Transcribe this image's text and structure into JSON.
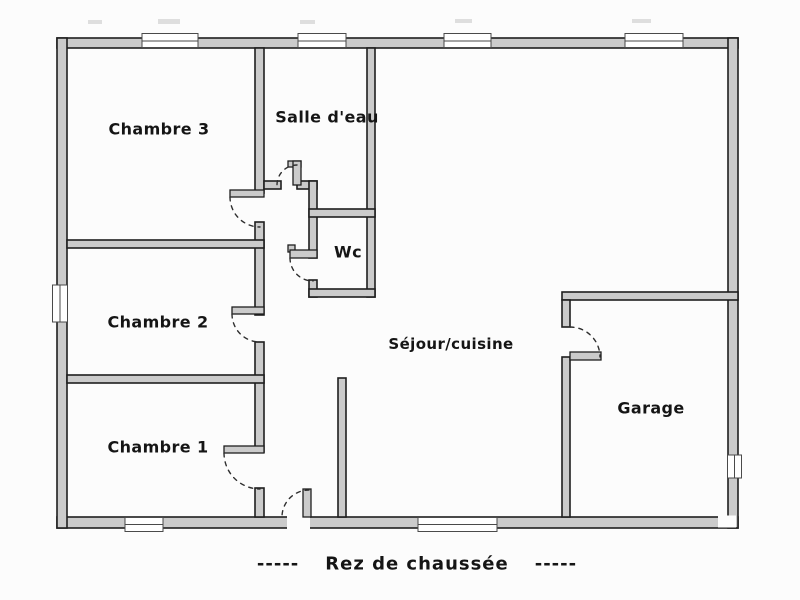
{
  "title": "Rez de chaussée floor plan",
  "colors": {
    "wall_fill": "#cbcbcb",
    "wall_stroke": "#1f1f1f",
    "background": "#fcfcfc",
    "text": "#151515"
  },
  "rooms": [
    {
      "id": "chambre3",
      "label": "Chambre 3"
    },
    {
      "id": "salle_deau",
      "label": "Salle d'eau"
    },
    {
      "id": "wc",
      "label": "Wc"
    },
    {
      "id": "chambre2",
      "label": "Chambre 2"
    },
    {
      "id": "chambre1",
      "label": "Chambre 1"
    },
    {
      "id": "sejour_cuisine",
      "label": "Séjour/cuisine"
    },
    {
      "id": "garage",
      "label": "Garage"
    }
  ],
  "caption": {
    "dashes_left": "-----",
    "text": "Rez de chaussée",
    "dashes_right": "-----"
  }
}
